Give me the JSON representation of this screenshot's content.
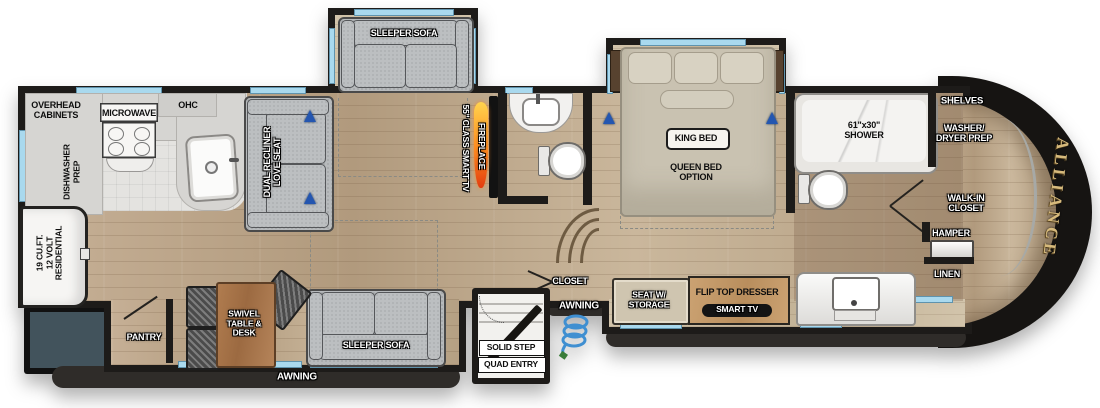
{
  "fp": {
    "brand": "ALLIANCE",
    "kitchen": {
      "overhead_cabinets": "OVERHEAD\nCABINETS",
      "microwave": "MICROWAVE",
      "ohc": "OHC",
      "dishwasher_prep": "DISHWASHER\nPREP",
      "refrigerator": "19 CU.FT.\n12 VOLT\nRESIDENTIAL",
      "pantry": "PANTRY"
    },
    "living": {
      "loveseat": "DUAL RECLINER\nLOVE SEAT",
      "sofa_top": "SLEEPER SOFA",
      "sofa_bottom": "SLEEPER SOFA",
      "table": "SWIVEL\nTABLE &\nDESK",
      "fireplace": "FIREPLACE",
      "tv": "55\" CLASS SMART TV"
    },
    "entry": {
      "closet": "CLOSET",
      "awning_left": "AWNING",
      "awning_right": "AWNING",
      "step_line1": "SOLID STEP",
      "step_line2": "QUAD ENTRY"
    },
    "bedroom": {
      "king_bed": "KING BED",
      "queen_option": "QUEEN BED\nOPTION",
      "seat_storage": "SEAT W/\nSTORAGE",
      "dresser": "FLIP TOP DRESSER",
      "smart_tv": "SMART TV"
    },
    "bath": {
      "shower": "61\"x30\"\nSHOWER",
      "shelves": "SHELVES",
      "washer_dryer": "WASHER/\nDRYER PREP",
      "walkin_closet": "WALK-IN\nCLOSET",
      "hamper": "HAMPER",
      "linen": "LINEN"
    },
    "colors": {
      "window": "#a9d9ee",
      "wall": "#1d1b19",
      "wood": "#bfa98c",
      "cap_gold": "#d7ba7c",
      "marker_blue": "#2456b0",
      "awning_bar": "#2f2c29",
      "flame_orange": "#ff8a1e",
      "table_wood": "#a9744b",
      "rear_bay_teal": "#42535c"
    }
  }
}
